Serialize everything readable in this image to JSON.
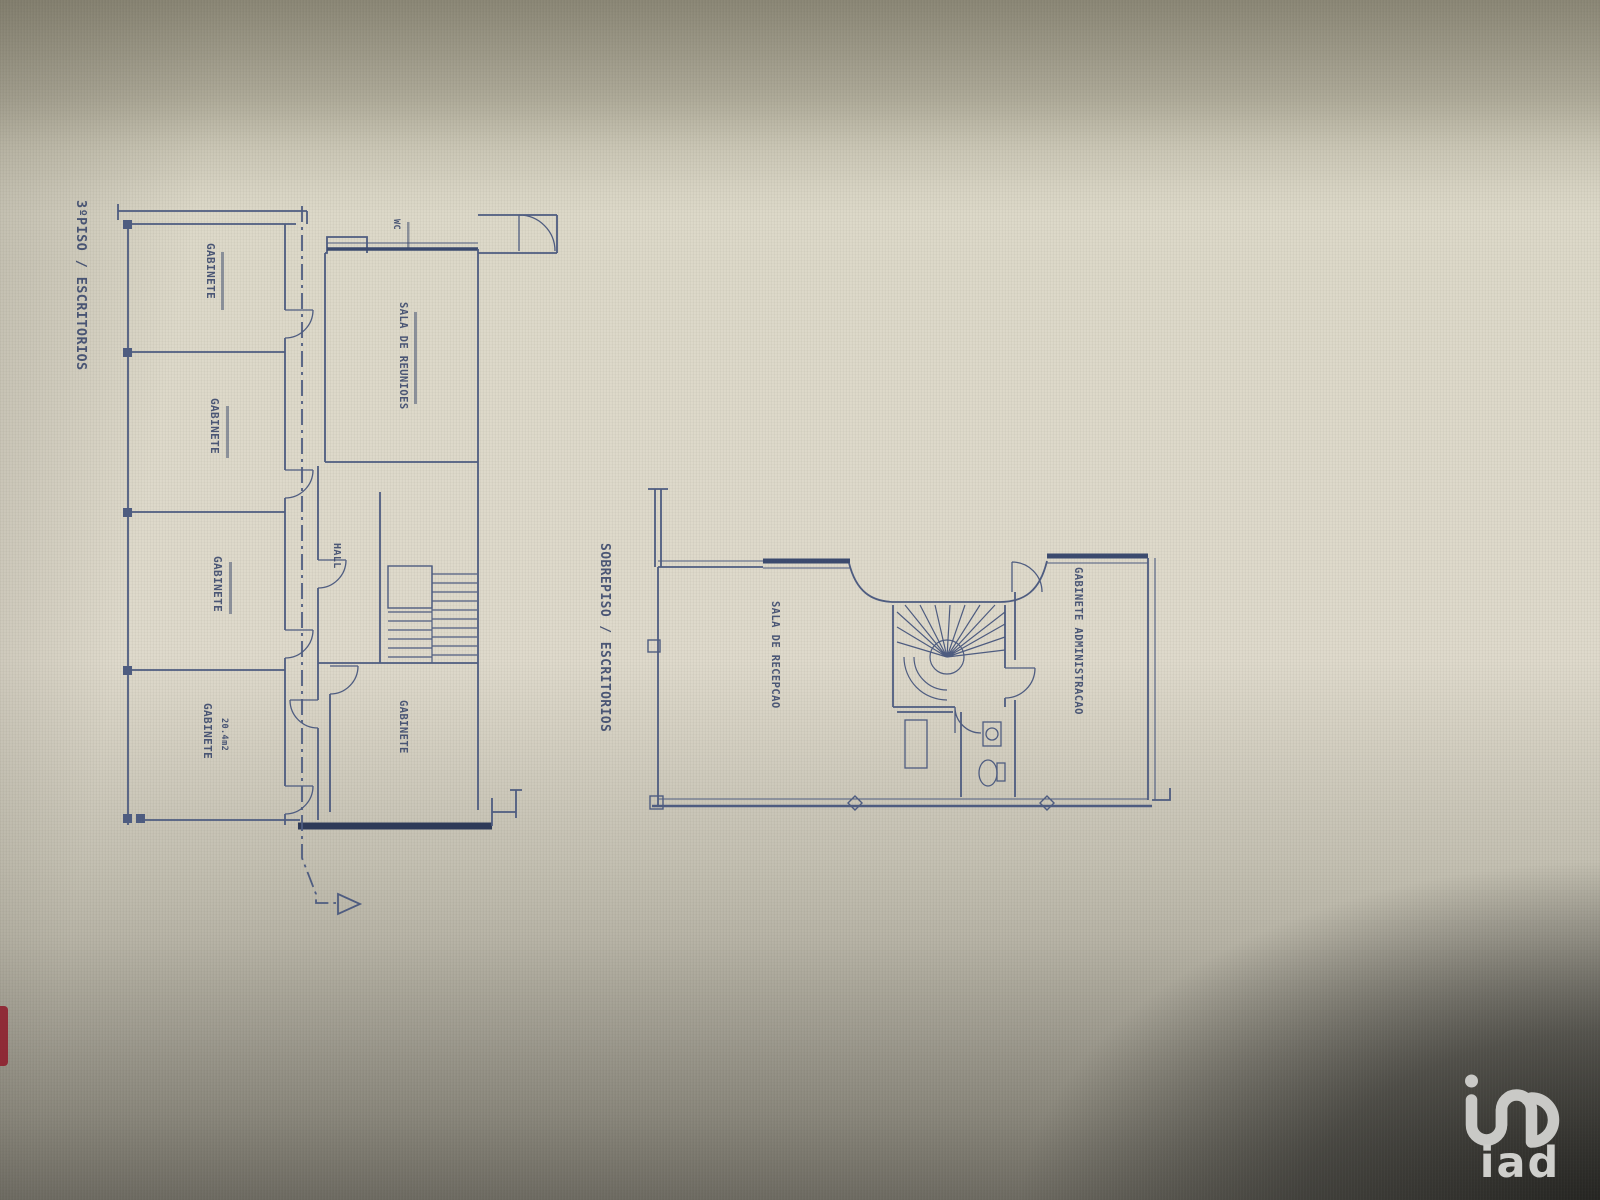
{
  "photo": {
    "kind": "floor-plan-blueprint-photo",
    "colors": {
      "line": "#4e5c80",
      "line_dark": "#35426244",
      "thick_wall": "#3b4a6e",
      "label": "#37456a",
      "paper": "#dcd8c8",
      "corner_dark": "#2b2b29",
      "logo": "#c9c9c6",
      "red_mark": "#8e2230"
    }
  },
  "plan_left": {
    "title": "3ºPISO / ESCRITORIOS",
    "rooms": {
      "gabinete1": {
        "label": "GABINETE"
      },
      "gabinete2": {
        "label": "GABINETE"
      },
      "gabinete3": {
        "label": "GABINETE"
      },
      "gabinete4": {
        "label": "GABINETE",
        "area": "20.4m2"
      },
      "sala_reunioes": {
        "label": "SALA DE REUNIOES"
      },
      "hall": {
        "label": "HALL"
      },
      "gabinete5": {
        "label": "GABINETE"
      },
      "wc": {
        "label": "WC"
      }
    }
  },
  "plan_right": {
    "title": "SOBREPISO / ESCRITORIOS",
    "rooms": {
      "sala_recepcao": {
        "label": "SALA DE RECEPCAO"
      },
      "gabinete_admin": {
        "label": "GABINETE ADMINISTRACAO"
      }
    }
  },
  "watermark": {
    "brand": "iad"
  }
}
